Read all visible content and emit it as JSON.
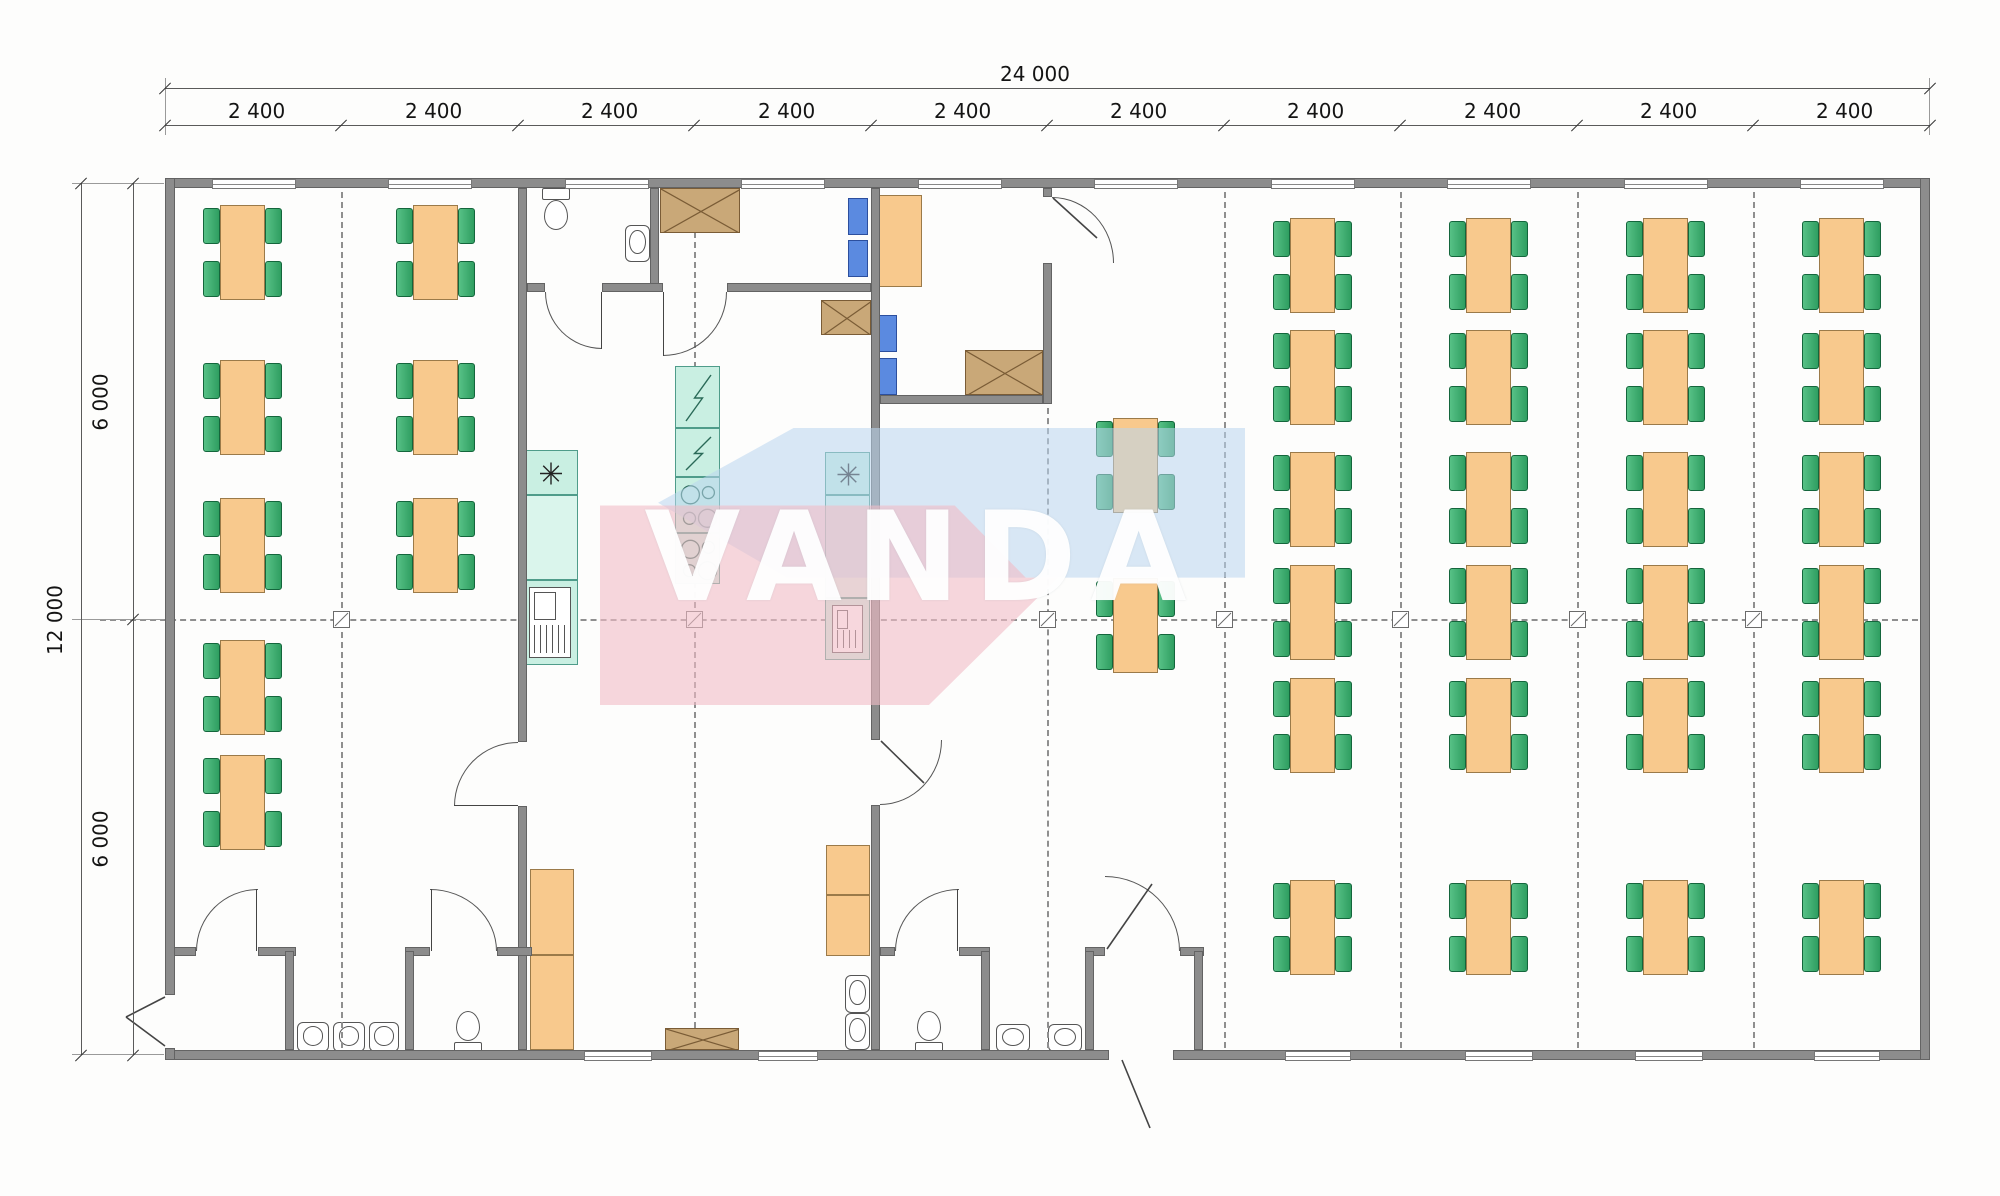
{
  "watermark": {
    "text": "VANDA",
    "blue": "#b9d6ef",
    "pink": "#f1bcc6"
  },
  "dimensions": {
    "total_width_label": "24 000",
    "segment_label": "2 400",
    "segment_count": 10,
    "total_height_label": "12 000",
    "half_height_label": "6 000",
    "segment_label_centers_x": [
      253,
      430,
      606,
      783,
      959,
      1135,
      1312,
      1489,
      1665,
      1841
    ],
    "tick_xs": [
      165,
      341,
      518,
      694,
      871,
      1047,
      1224,
      1400,
      1577,
      1753,
      1930
    ]
  },
  "colors": {
    "wall": "#8c8c8c",
    "table": "#f8c98d",
    "chair_green": "#3fae6e",
    "chair_blue": "#5b8ae0",
    "equipment_teal": "#c9efe2",
    "box_tan": "#c9a878"
  },
  "plan": {
    "walls": [
      [
        165,
        178,
        1765,
        10
      ],
      [
        165,
        1050,
        944,
        10
      ],
      [
        1173,
        1050,
        757,
        10
      ],
      [
        165,
        178,
        10,
        817
      ],
      [
        165,
        1048,
        10,
        12
      ],
      [
        1920,
        178,
        10,
        882
      ],
      [
        518,
        188,
        9,
        554
      ],
      [
        518,
        806,
        9,
        244
      ],
      [
        650,
        188,
        9,
        104
      ],
      [
        871,
        188,
        9,
        552
      ],
      [
        871,
        805,
        9,
        245
      ],
      [
        1043,
        188,
        9,
        9
      ],
      [
        1043,
        263,
        9,
        141
      ],
      [
        527,
        283,
        18,
        9
      ],
      [
        602,
        283,
        61,
        9
      ],
      [
        727,
        283,
        144,
        9
      ],
      [
        880,
        395,
        163,
        9
      ],
      [
        174,
        947,
        22,
        9
      ],
      [
        258,
        947,
        38,
        9
      ],
      [
        405,
        947,
        25,
        9
      ],
      [
        497,
        947,
        35,
        9
      ],
      [
        880,
        947,
        15,
        9
      ],
      [
        959,
        947,
        31,
        9
      ],
      [
        1085,
        947,
        20,
        9
      ],
      [
        1180,
        947,
        24,
        9
      ],
      [
        285,
        951,
        9,
        99
      ],
      [
        405,
        951,
        9,
        99
      ],
      [
        981,
        951,
        9,
        99
      ],
      [
        1085,
        951,
        9,
        99
      ],
      [
        1194,
        951,
        9,
        99
      ]
    ],
    "windows_top": {
      "xs": [
        212,
        388,
        565,
        741,
        918,
        1094,
        1271,
        1447,
        1624,
        1800
      ],
      "y": 179,
      "w": 82,
      "h": 8
    },
    "windows_bottom": [
      [
        584,
        66
      ],
      [
        758,
        58
      ],
      [
        1285,
        64
      ],
      [
        1465,
        66
      ],
      [
        1635,
        66
      ],
      [
        1814,
        64
      ]
    ],
    "grid": {
      "v_full": [
        341,
        694,
        1224,
        1400,
        1577,
        1753
      ],
      "v_partial": [
        [
          1047,
          408,
          1048
        ]
      ],
      "v_y1": 192,
      "v_y2": 1048,
      "h_y": 619,
      "h_x1": 100,
      "h_x2": 1918,
      "marker_xs": [
        333,
        686,
        1039,
        1216,
        1392,
        1569,
        1745
      ]
    },
    "tables": [
      [
        203,
        205
      ],
      [
        203,
        360
      ],
      [
        203,
        498
      ],
      [
        203,
        640
      ],
      [
        203,
        755
      ],
      [
        396,
        205
      ],
      [
        396,
        360
      ],
      [
        396,
        498
      ],
      [
        1096,
        418
      ],
      [
        1096,
        578
      ],
      [
        1273,
        218
      ],
      [
        1273,
        330
      ],
      [
        1273,
        452
      ],
      [
        1273,
        565
      ],
      [
        1273,
        678
      ],
      [
        1273,
        880
      ],
      [
        1449,
        218
      ],
      [
        1449,
        330
      ],
      [
        1449,
        452
      ],
      [
        1449,
        565
      ],
      [
        1449,
        678
      ],
      [
        1449,
        880
      ],
      [
        1626,
        218
      ],
      [
        1626,
        330
      ],
      [
        1626,
        452
      ],
      [
        1626,
        565
      ],
      [
        1626,
        678
      ],
      [
        1626,
        880
      ],
      [
        1802,
        218
      ],
      [
        1802,
        330
      ],
      [
        1802,
        452
      ],
      [
        1802,
        565
      ],
      [
        1802,
        678
      ],
      [
        1802,
        880
      ]
    ],
    "office_desk": [
      877,
      195,
      45,
      92
    ],
    "blue_chairs": [
      [
        848,
        198,
        20,
        37
      ],
      [
        848,
        240,
        20,
        37
      ],
      [
        877,
        315,
        20,
        37
      ],
      [
        877,
        358,
        20,
        37
      ]
    ],
    "tan_boxes": [
      [
        660,
        188,
        80,
        45
      ],
      [
        821,
        300,
        50,
        35
      ],
      [
        965,
        350,
        78,
        45
      ],
      [
        665,
        1028,
        74,
        22
      ]
    ],
    "teal_units": [
      [
        522,
        450,
        56,
        45,
        "asterisk"
      ],
      [
        522,
        495,
        56,
        85,
        "plain"
      ],
      [
        522,
        580,
        56,
        85,
        "grille"
      ],
      [
        675,
        366,
        45,
        62,
        "bolt"
      ],
      [
        675,
        428,
        45,
        49,
        "bolt"
      ],
      [
        675,
        477,
        45,
        56,
        "burners"
      ],
      [
        675,
        533,
        45,
        51,
        "burners"
      ],
      [
        825,
        452,
        45,
        43,
        "asterisk"
      ],
      [
        825,
        495,
        45,
        103,
        "plain"
      ],
      [
        825,
        598,
        45,
        62,
        "grille"
      ]
    ],
    "cabinets": [
      [
        530,
        869,
        44,
        86
      ],
      [
        530,
        955,
        44,
        95
      ],
      [
        826,
        845,
        44,
        50
      ],
      [
        826,
        895,
        44,
        61
      ]
    ],
    "toilets": [
      [
        540,
        188,
        "down"
      ],
      [
        452,
        1008,
        "up"
      ],
      [
        913,
        1008,
        "up"
      ]
    ],
    "basins_up": [
      [
        297,
        1022,
        32,
        30
      ],
      [
        333,
        1022,
        32,
        30
      ],
      [
        369,
        1022,
        30,
        30
      ],
      [
        996,
        1024,
        34,
        28
      ],
      [
        1048,
        1024,
        34,
        28
      ]
    ],
    "basins_left": [
      [
        845,
        975,
        25,
        38
      ],
      [
        845,
        1013,
        25,
        37
      ],
      [
        625,
        225,
        25,
        37
      ]
    ],
    "door_arcs": [
      [
        545,
        292,
        57,
        57,
        "bl"
      ],
      [
        663,
        292,
        64,
        64,
        "br"
      ],
      [
        454,
        742,
        64,
        64,
        "tl"
      ],
      [
        880,
        740,
        62,
        65,
        "br"
      ],
      [
        1052,
        197,
        62,
        66,
        "tr"
      ],
      [
        196,
        889,
        62,
        62,
        "tl"
      ],
      [
        430,
        889,
        67,
        62,
        "tr"
      ],
      [
        895,
        889,
        64,
        62,
        "tl"
      ],
      [
        1105,
        876,
        75,
        75,
        "tr"
      ]
    ],
    "door_leaves_v": [
      [
        601,
        292,
        57
      ],
      [
        663,
        292,
        64
      ],
      [
        256,
        889,
        62
      ],
      [
        431,
        889,
        62
      ],
      [
        957,
        889,
        62
      ]
    ],
    "door_leaves_h": [
      [
        454,
        805,
        64
      ]
    ],
    "west_gap": [
      165,
      995,
      10,
      53
    ],
    "south_gap_x": [
      1109,
      1173
    ]
  }
}
